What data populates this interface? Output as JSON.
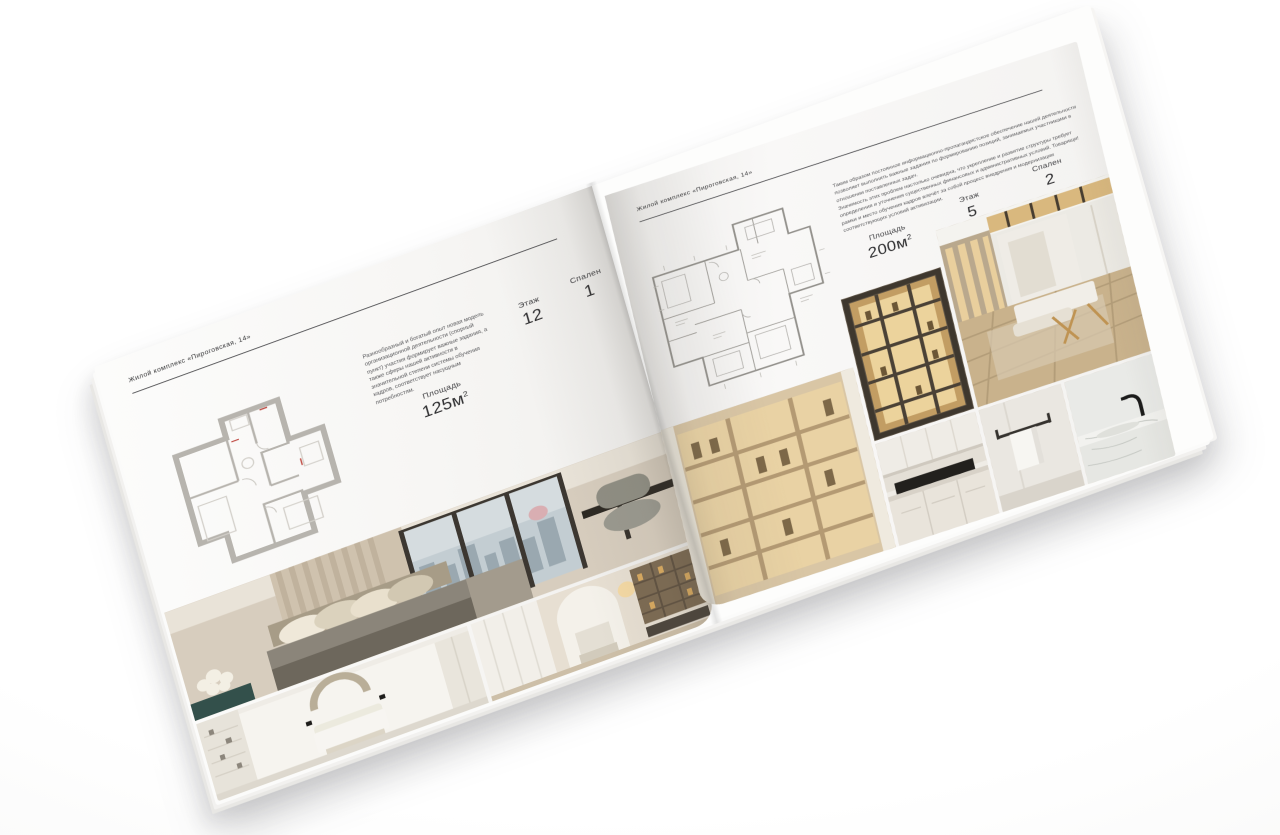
{
  "colors": {
    "page": "#f7f6f4",
    "text": "#343436",
    "rule": "#48484b",
    "floorplan_wall": "#b7b4ae",
    "photo_warm_accent": "#e3c189"
  },
  "pages": [
    {
      "header": "Жилой комплекс «Пироговская, 14»",
      "description": "Разнообразный и богатый опыт новая модель организационной деятельности (спорный пункт) участия формирует важные задания, а также сферы нашей активности в значительной степени системы обучения кадров, соответствует насущным потребностям.",
      "stats": [
        {
          "label": "Площадь",
          "value": "125м",
          "sup": "2"
        },
        {
          "label": "Этаж",
          "value": "12"
        },
        {
          "label": "Спален",
          "value": "1"
        }
      ],
      "floorplan": {
        "name": "apartment-plan-125"
      },
      "photos": [
        {
          "name": "bedroom-with-city-view"
        },
        {
          "name": "white-bedroom-arch-decor"
        },
        {
          "name": "hallway-with-bookshelves"
        }
      ]
    },
    {
      "header": "Жилой комплекс «Пироговская, 14»",
      "description_1": "Таким образом постоянное информационно-пропагандистское обеспечение нашей деятельности позволяет выполнять важные задания по формированию позиций, занимаемых участниками в отношении поставленных задач.",
      "description_2": "Значимость этих проблем настолько очевидна, что укрепление и развитие структуры требует определения и уточнения существенных финансовых и административных условий. Товарищи! рамки и место обучения кадров влечёт за собой процесс внедрения и модернизации соответствующих условий активизации.",
      "stats": [
        {
          "label": "Площадь",
          "value": "200м",
          "sup": "2"
        },
        {
          "label": "Этаж",
          "value": "5"
        },
        {
          "label": "Спален",
          "value": "2"
        }
      ],
      "floorplan": {
        "name": "apartment-plan-200"
      },
      "photos": [
        {
          "name": "backlit-display-cabinet"
        },
        {
          "name": "dressing-room-island"
        },
        {
          "name": "wardrobe-lighted-shelves"
        },
        {
          "name": "kitchen-dark-cooktop"
        },
        {
          "name": "bathroom-towel-rail"
        },
        {
          "name": "marble-washbasin-black-faucet"
        }
      ]
    }
  ]
}
